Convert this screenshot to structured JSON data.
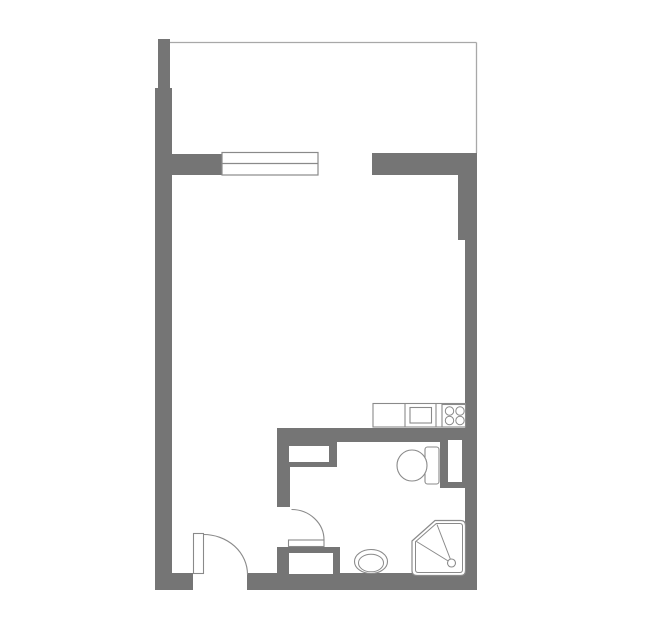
{
  "canvas": {
    "width": 659,
    "height": 631,
    "background": "#ffffff"
  },
  "colors": {
    "wall": "#757575",
    "thin_line": "#a8a8a8",
    "window_line": "#8a8a8a",
    "fixture_line": "#8a8a8a",
    "white": "#ffffff",
    "none": "none"
  },
  "floorplan": {
    "type": "studio-apartment-floor-plan",
    "rooms": [
      "balcony",
      "main-room",
      "bathroom"
    ],
    "fixtures": [
      "window",
      "entry-door",
      "bathroom-door",
      "kitchen-counter",
      "sink",
      "stove",
      "toilet",
      "washbasin",
      "shower",
      "closet-niche",
      "vanity-niche",
      "duct-niche"
    ],
    "shapes": [
      {
        "name": "left-wall-upper",
        "kind": "rect",
        "attrs": {
          "x": 158,
          "y": 39,
          "width": 12,
          "height": 49,
          "fill": "wall"
        }
      },
      {
        "name": "left-wall-main",
        "kind": "rect",
        "attrs": {
          "x": 155,
          "y": 88,
          "width": 17,
          "height": 502,
          "fill": "wall"
        }
      },
      {
        "name": "divider-wall-left",
        "kind": "rect",
        "attrs": {
          "x": 171,
          "y": 154,
          "width": 51,
          "height": 21,
          "fill": "wall"
        }
      },
      {
        "name": "divider-wall-right",
        "kind": "rect",
        "attrs": {
          "x": 372,
          "y": 153,
          "width": 105,
          "height": 22,
          "fill": "wall"
        }
      },
      {
        "name": "right-wall-upper",
        "kind": "rect",
        "attrs": {
          "x": 458,
          "y": 175,
          "width": 19,
          "height": 65,
          "fill": "wall"
        }
      },
      {
        "name": "right-wall-main",
        "kind": "rect",
        "attrs": {
          "x": 465,
          "y": 240,
          "width": 12,
          "height": 350,
          "fill": "wall"
        }
      },
      {
        "name": "bottom-wall-left",
        "kind": "rect",
        "attrs": {
          "x": 155,
          "y": 573,
          "width": 38,
          "height": 17,
          "fill": "wall"
        }
      },
      {
        "name": "bottom-wall-right",
        "kind": "rect",
        "attrs": {
          "x": 247,
          "y": 573,
          "width": 230,
          "height": 17,
          "fill": "wall"
        }
      },
      {
        "name": "bathroom-top-wall",
        "kind": "rect",
        "attrs": {
          "x": 277,
          "y": 428,
          "width": 200,
          "height": 14,
          "fill": "wall"
        }
      },
      {
        "name": "bathroom-left-wall",
        "kind": "rect",
        "attrs": {
          "x": 277,
          "y": 428,
          "width": 13,
          "height": 79,
          "fill": "wall"
        }
      },
      {
        "name": "closet-block",
        "kind": "rect",
        "attrs": {
          "x": 277,
          "y": 442,
          "width": 60,
          "height": 25,
          "fill": "wall"
        }
      },
      {
        "name": "vanity-block",
        "kind": "rect",
        "attrs": {
          "x": 277,
          "y": 547,
          "width": 63,
          "height": 28,
          "fill": "wall"
        }
      },
      {
        "name": "duct-block",
        "kind": "rect",
        "attrs": {
          "x": 440,
          "y": 433,
          "width": 37,
          "height": 55,
          "fill": "wall"
        }
      },
      {
        "name": "balcony-top-line",
        "kind": "line",
        "attrs": {
          "x1": 170,
          "y1": 42.5,
          "x2": 476.5,
          "y2": 42.5,
          "stroke": "thin_line",
          "stroke-width": 1.3
        }
      },
      {
        "name": "balcony-right-line",
        "kind": "line",
        "attrs": {
          "x1": 476.5,
          "y1": 42.5,
          "x2": 476.5,
          "y2": 153,
          "stroke": "thin_line",
          "stroke-width": 1.3
        }
      },
      {
        "name": "window-frame",
        "kind": "rect",
        "attrs": {
          "x": 222,
          "y": 152.5,
          "width": 96,
          "height": 22.5,
          "fill": "white",
          "stroke": "window_line",
          "stroke-width": 1.2
        }
      },
      {
        "name": "window-mid-line",
        "kind": "line",
        "attrs": {
          "x1": 222,
          "y1": 163.5,
          "x2": 318,
          "y2": 163.5,
          "stroke": "window_line",
          "stroke-width": 1.2
        }
      },
      {
        "name": "closet-niche",
        "kind": "rect",
        "attrs": {
          "x": 289,
          "y": 446,
          "width": 40,
          "height": 16,
          "fill": "white"
        }
      },
      {
        "name": "vanity-niche",
        "kind": "rect",
        "attrs": {
          "x": 289,
          "y": 553,
          "width": 44,
          "height": 21,
          "fill": "white"
        }
      },
      {
        "name": "duct-niche",
        "kind": "rect",
        "attrs": {
          "x": 448,
          "y": 440,
          "width": 14,
          "height": 42,
          "fill": "white"
        }
      },
      {
        "name": "kitchen-counter",
        "kind": "rect",
        "attrs": {
          "x": 373,
          "y": 403.5,
          "width": 92.5,
          "height": 23.5,
          "fill": "white",
          "stroke": "fixture_line",
          "stroke-width": 1.1
        }
      },
      {
        "name": "counter-divider-1",
        "kind": "line",
        "attrs": {
          "x1": 405,
          "y1": 403.5,
          "x2": 405,
          "y2": 427,
          "stroke": "fixture_line",
          "stroke-width": 1.1
        }
      },
      {
        "name": "counter-divider-2",
        "kind": "line",
        "attrs": {
          "x1": 436,
          "y1": 403.5,
          "x2": 436,
          "y2": 427,
          "stroke": "fixture_line",
          "stroke-width": 1.1
        }
      },
      {
        "name": "sink-basin",
        "kind": "rect",
        "attrs": {
          "x": 410,
          "y": 407.5,
          "width": 21.5,
          "height": 15.5,
          "fill": "white",
          "stroke": "fixture_line",
          "stroke-width": 1.1
        }
      },
      {
        "name": "stove",
        "kind": "rect",
        "attrs": {
          "x": 442,
          "y": 404.5,
          "width": 23.5,
          "height": 22.5,
          "fill": "white",
          "stroke": "fixture_line",
          "stroke-width": 1.1
        }
      },
      {
        "name": "stove-burner-1",
        "kind": "circle",
        "attrs": {
          "cx": 449.5,
          "cy": 411,
          "r": 4.2,
          "fill": "white",
          "stroke": "fixture_line",
          "stroke-width": 1
        }
      },
      {
        "name": "stove-burner-2",
        "kind": "circle",
        "attrs": {
          "cx": 460,
          "cy": 411,
          "r": 4.2,
          "fill": "white",
          "stroke": "fixture_line",
          "stroke-width": 1
        }
      },
      {
        "name": "stove-burner-3",
        "kind": "circle",
        "attrs": {
          "cx": 449.5,
          "cy": 420.5,
          "r": 4.2,
          "fill": "white",
          "stroke": "fixture_line",
          "stroke-width": 1
        }
      },
      {
        "name": "stove-burner-4",
        "kind": "circle",
        "attrs": {
          "cx": 460,
          "cy": 420.5,
          "r": 4.2,
          "fill": "white",
          "stroke": "fixture_line",
          "stroke-width": 1
        }
      },
      {
        "name": "toilet-tank",
        "kind": "rect",
        "attrs": {
          "x": 425,
          "y": 447,
          "width": 14,
          "height": 37,
          "rx": 2.5,
          "fill": "white",
          "stroke": "fixture_line",
          "stroke-width": 1.1
        }
      },
      {
        "name": "toilet-bowl",
        "kind": "ellipse",
        "attrs": {
          "cx": 412,
          "cy": 465.5,
          "rx": 15,
          "ry": 15.5,
          "fill": "white",
          "stroke": "fixture_line",
          "stroke-width": 1.1
        }
      },
      {
        "name": "washbasin-outer",
        "kind": "ellipse",
        "attrs": {
          "cx": 371,
          "cy": 561.5,
          "rx": 16.5,
          "ry": 12,
          "fill": "white",
          "stroke": "fixture_line",
          "stroke-width": 1.1
        }
      },
      {
        "name": "washbasin-inner",
        "kind": "ellipse",
        "attrs": {
          "cx": 371,
          "cy": 563,
          "rx": 12.5,
          "ry": 8.8,
          "fill": "white",
          "stroke": "fixture_line",
          "stroke-width": 1
        }
      },
      {
        "name": "shower-tray",
        "kind": "path",
        "attrs": {
          "d": "M 412 541 L 435 520.5 L 460.5 520.5 Q 465.5 520.5 465.5 525.5 L 465.5 570.5 Q 465.5 575.5 460.5 575.5 L 417 575.5 Q 412 575.5 412 570.5 Z",
          "fill": "white",
          "stroke": "fixture_line",
          "stroke-width": 1.2
        }
      },
      {
        "name": "shower-tray-inner",
        "kind": "path",
        "attrs": {
          "d": "M 415.5 541.8 L 436.3 523.5 L 459.8 523.5 Q 462.5 523.5 462.5 526.3 L 462.5 569.7 Q 462.5 572.5 459.8 572.5 L 418.3 572.5 Q 415.5 572.5 415.5 569.7 Z",
          "fill": "none",
          "stroke": "fixture_line",
          "stroke-width": 1
        }
      },
      {
        "name": "shower-spray-line-1",
        "kind": "line",
        "attrs": {
          "x1": 416.5,
          "y1": 541.5,
          "x2": 449,
          "y2": 561.5,
          "stroke": "fixture_line",
          "stroke-width": 1
        }
      },
      {
        "name": "shower-spray-line-2",
        "kind": "line",
        "attrs": {
          "x1": 437,
          "y1": 524.5,
          "x2": 450.5,
          "y2": 559.5,
          "stroke": "fixture_line",
          "stroke-width": 1
        }
      },
      {
        "name": "shower-drain",
        "kind": "circle",
        "attrs": {
          "cx": 451.5,
          "cy": 563,
          "r": 4,
          "fill": "white",
          "stroke": "fixture_line",
          "stroke-width": 1.1
        }
      },
      {
        "name": "entry-door-leaf",
        "kind": "rect",
        "attrs": {
          "x": 193.5,
          "y": 533.5,
          "width": 10,
          "height": 40,
          "fill": "white",
          "stroke": "fixture_line",
          "stroke-width": 1.1
        }
      },
      {
        "name": "entry-door-arc",
        "kind": "path",
        "attrs": {
          "d": "M 203.5 534.5 A 44 40 0 0 1 247.5 574.5",
          "fill": "none",
          "stroke": "fixture_line",
          "stroke-width": 1.1
        }
      },
      {
        "name": "bathroom-door-leaf",
        "kind": "rect",
        "attrs": {
          "x": 288.5,
          "y": 540,
          "width": 35.5,
          "height": 6.5,
          "fill": "white",
          "stroke": "fixture_line",
          "stroke-width": 1.1
        }
      },
      {
        "name": "bathroom-door-arc",
        "kind": "path",
        "attrs": {
          "d": "M 291.5 509.5 A 32.5 30.5 0 0 1 324 540",
          "fill": "none",
          "stroke": "fixture_line",
          "stroke-width": 1.1
        }
      }
    ]
  }
}
